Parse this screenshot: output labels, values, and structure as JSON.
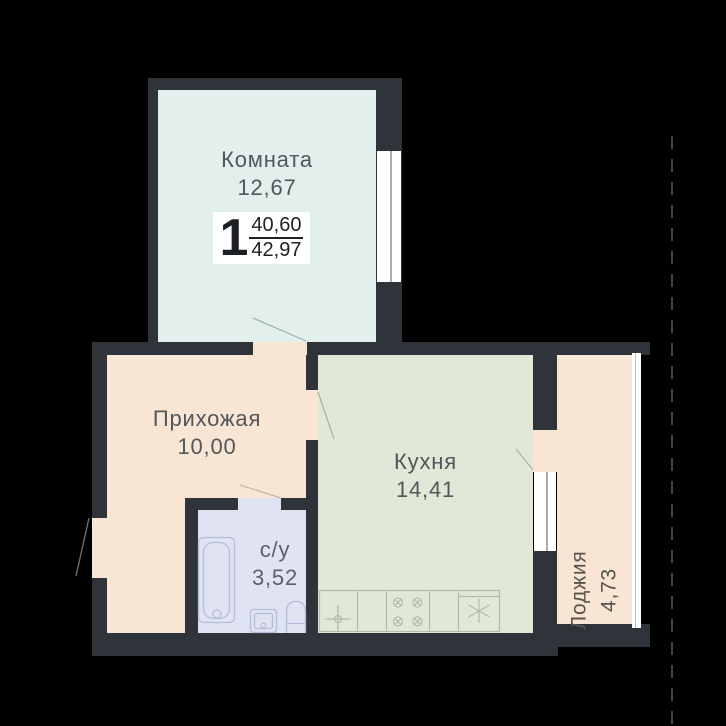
{
  "plan": {
    "badge": {
      "rooms": "1",
      "area_top": "40,60",
      "area_bottom": "42,97"
    },
    "rooms": [
      {
        "id": "living",
        "name": "Комната",
        "area": "12,67"
      },
      {
        "id": "hallway",
        "name": "Прихожая",
        "area": "10,00"
      },
      {
        "id": "kitchen",
        "name": "Кухня",
        "area": "14,41"
      },
      {
        "id": "bathroom",
        "name": "с/у",
        "area": "3,52"
      },
      {
        "id": "loggia",
        "name": "Лоджия",
        "area": "4,73"
      }
    ],
    "colors": {
      "background": "#000000",
      "wall": "#2e343a",
      "living_fill": "#e3efec",
      "hallway_fill": "#f8e5d3",
      "kitchen_fill": "#e2e8d8",
      "bathroom_fill": "#dfe3f2",
      "loggia_fill": "#f8e5d3",
      "window": "#ffffff",
      "badge_bg": "#ffffff",
      "label_text": "#53565b"
    }
  }
}
